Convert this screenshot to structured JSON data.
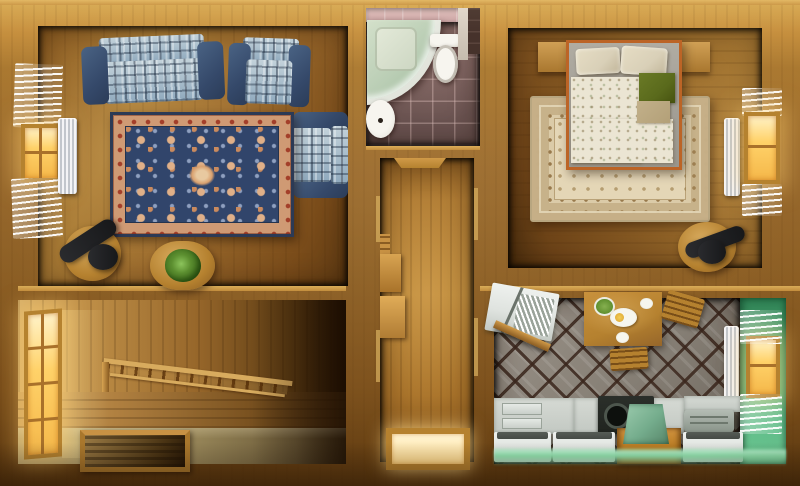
{
  "scene": {
    "type": "floor-plan-3d-top-view",
    "rooms": [
      {
        "name": "living-room",
        "items": [
          "patchwork-sofa",
          "patchwork-armchair",
          "patchwork-armchair",
          "ornate-navy-rug",
          "desk-with-black-chair",
          "coffee-table-with-plant",
          "window-with-blinds",
          "radiator"
        ]
      },
      {
        "name": "bathroom",
        "items": [
          "corner-shower",
          "toilet",
          "pedestal-sink",
          "tiled-floor"
        ]
      },
      {
        "name": "hallway",
        "items": [
          "door-lintel",
          "wall-steps",
          "lit-floor-hatch"
        ]
      },
      {
        "name": "staircase-room",
        "items": [
          "glowing-window",
          "descending-stair-railing",
          "stair-opening"
        ]
      },
      {
        "name": "bedroom",
        "items": [
          "double-bed",
          "pillows",
          "green-blanket",
          "tan-blanket",
          "beige-ornate-rug",
          "headboard-shelf",
          "desk-with-black-chair",
          "window-with-blinds",
          "radiator"
        ]
      },
      {
        "name": "kitchen",
        "items": [
          "dining-table-with-breakfast",
          "wood-chairs",
          "white-counters",
          "stove",
          "green-sink-cabinet",
          "dish-rack-counter",
          "window-with-blinds",
          "radiator",
          "green-accent-wall"
        ]
      }
    ]
  },
  "palette": {
    "woodTop": "#d8a94f",
    "woodMid": "#a9772f",
    "woodDark": "#5e3a10",
    "livingFloor": "#9c6b2d",
    "hallFloor": "#b07c34",
    "bedroomFloor": "#96682a",
    "sofaDenim": "#2b3c58",
    "sofaPatch": "#9fb6c6",
    "rugNavy": "#31456b",
    "rugSalmon": "#cf9a74",
    "rugEdge": "#2c3a55",
    "bathFloor": "#6f5453",
    "bathWallTile": "#c9a2a2",
    "showerGlass": "#b9cdb4",
    "porcelain": "#efede6",
    "bedroomRug": "#dbcba8",
    "duvet": "#ebe5d3",
    "sheetGray": "#a8a49c",
    "pillow": "#d9d0b8",
    "blanketGreen": "#5a6a1c",
    "blanketTan": "#b3a078",
    "bedFrame": "#bc6426",
    "kitchenTile": "#8d857c",
    "kitchenGreen": "#4fae7e",
    "kitchenGlow": "#8fe4ae",
    "counterWhite": "#dfe3df",
    "counterTop": "#454a45",
    "stoveBlack": "#20241f",
    "sinkGreen": "#74ac8c",
    "tableWood": "#b5812f",
    "windowGlow": "#ffd269",
    "windowFrame": "#b5822f",
    "radiatorWhite": "#e9ebee",
    "chairBlack": "#17181a",
    "plantGreen": "#4a7a24"
  }
}
